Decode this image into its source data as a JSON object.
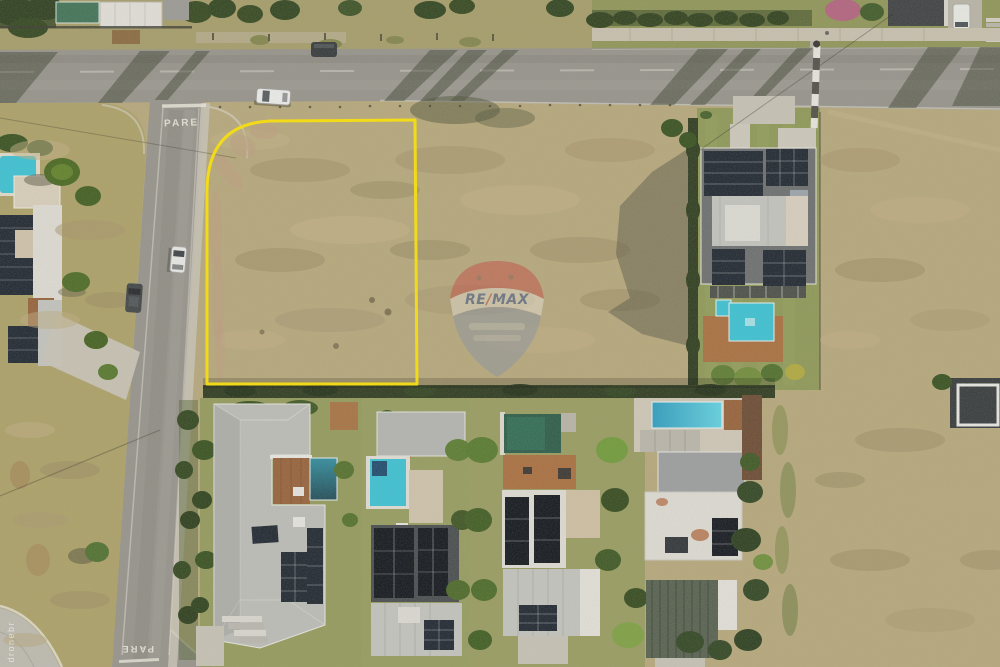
{
  "scene": {
    "width": 1000,
    "height": 667,
    "kind": "aerial-drone-photograph"
  },
  "road_markings": {
    "stop_top": "PARE",
    "stop_bottom": "PARE"
  },
  "highlighted_lot": {
    "outline_color": "#ffe400",
    "stroke_width": 3
  },
  "watermarks": {
    "remax_balloon": {
      "text": "RE/MAX",
      "text_re": "RE",
      "slash": "/",
      "text_max": "MAX",
      "text_color": "#2b4a8f",
      "slash_color": "#c4463e",
      "top_color": "#c4463e",
      "band_color": "#eae5da",
      "bottom_color": "#8891a5",
      "opacity": 0.5
    },
    "photo_credit": {
      "text": "dronebr",
      "color": "#ffffff"
    }
  },
  "palette": {
    "asphalt": "#95938c",
    "dirt": "#b6a87c",
    "grass": "#aca168",
    "lawn": "#8d9857",
    "hedge": "#2c3a1f",
    "tree": "#35501f",
    "solar": "#1d2530",
    "pool": "#3ac2d5",
    "pool_green": "#2a5b48",
    "deck_wood": "#96613a",
    "paver": "#a96e3f",
    "concrete": "#c6c2b6",
    "paint": "#eae7dd",
    "shadow": "#3f4534",
    "roof_light": "#c3c4c0",
    "roof_white": "#dedcd5",
    "roof_dark": "#54565a"
  }
}
